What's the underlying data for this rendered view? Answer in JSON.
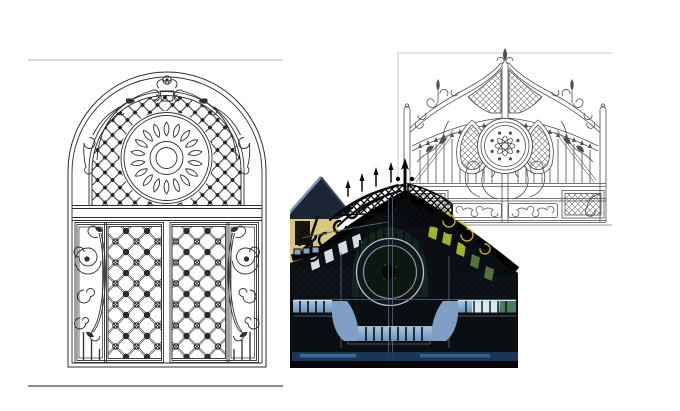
{
  "page": {
    "background": "#ffffff"
  },
  "rules": {
    "top_color": "#d6d6d6",
    "bottom_color": "#8d8d8d"
  },
  "figures": {
    "left_drawing": {
      "name": "arched-double-door-gate-line-drawing",
      "ink": "#2e2e2e"
    },
    "right_drawing": {
      "name": "ornate-double-gate-line-drawing",
      "ink": "#4f4f4f",
      "border": "#c9c9c9",
      "baseline": "#9a9a9a"
    },
    "photo": {
      "name": "installed-wrought-iron-gate-photo",
      "colors": {
        "iron": "#0b0e12",
        "band": "#000000",
        "sky_slot": "#e7eef4",
        "roof": "#1b2533",
        "roof_highlight": "#7892b2",
        "wall": "#d9c87c",
        "foliage": "#bccf35",
        "foliage_dark": "#52713d",
        "reflection_blue": "#82a4c8",
        "reflection_mid": "#7fa0c4",
        "reflection_bright": "#d9e7f2",
        "navy_streak": "#1d3a5e",
        "ring_metal": "#b9c0c7",
        "panel_line": "#5a6a7a",
        "arch_panel_green": "#15241d",
        "gold_accent": "#c2a13c"
      }
    }
  }
}
